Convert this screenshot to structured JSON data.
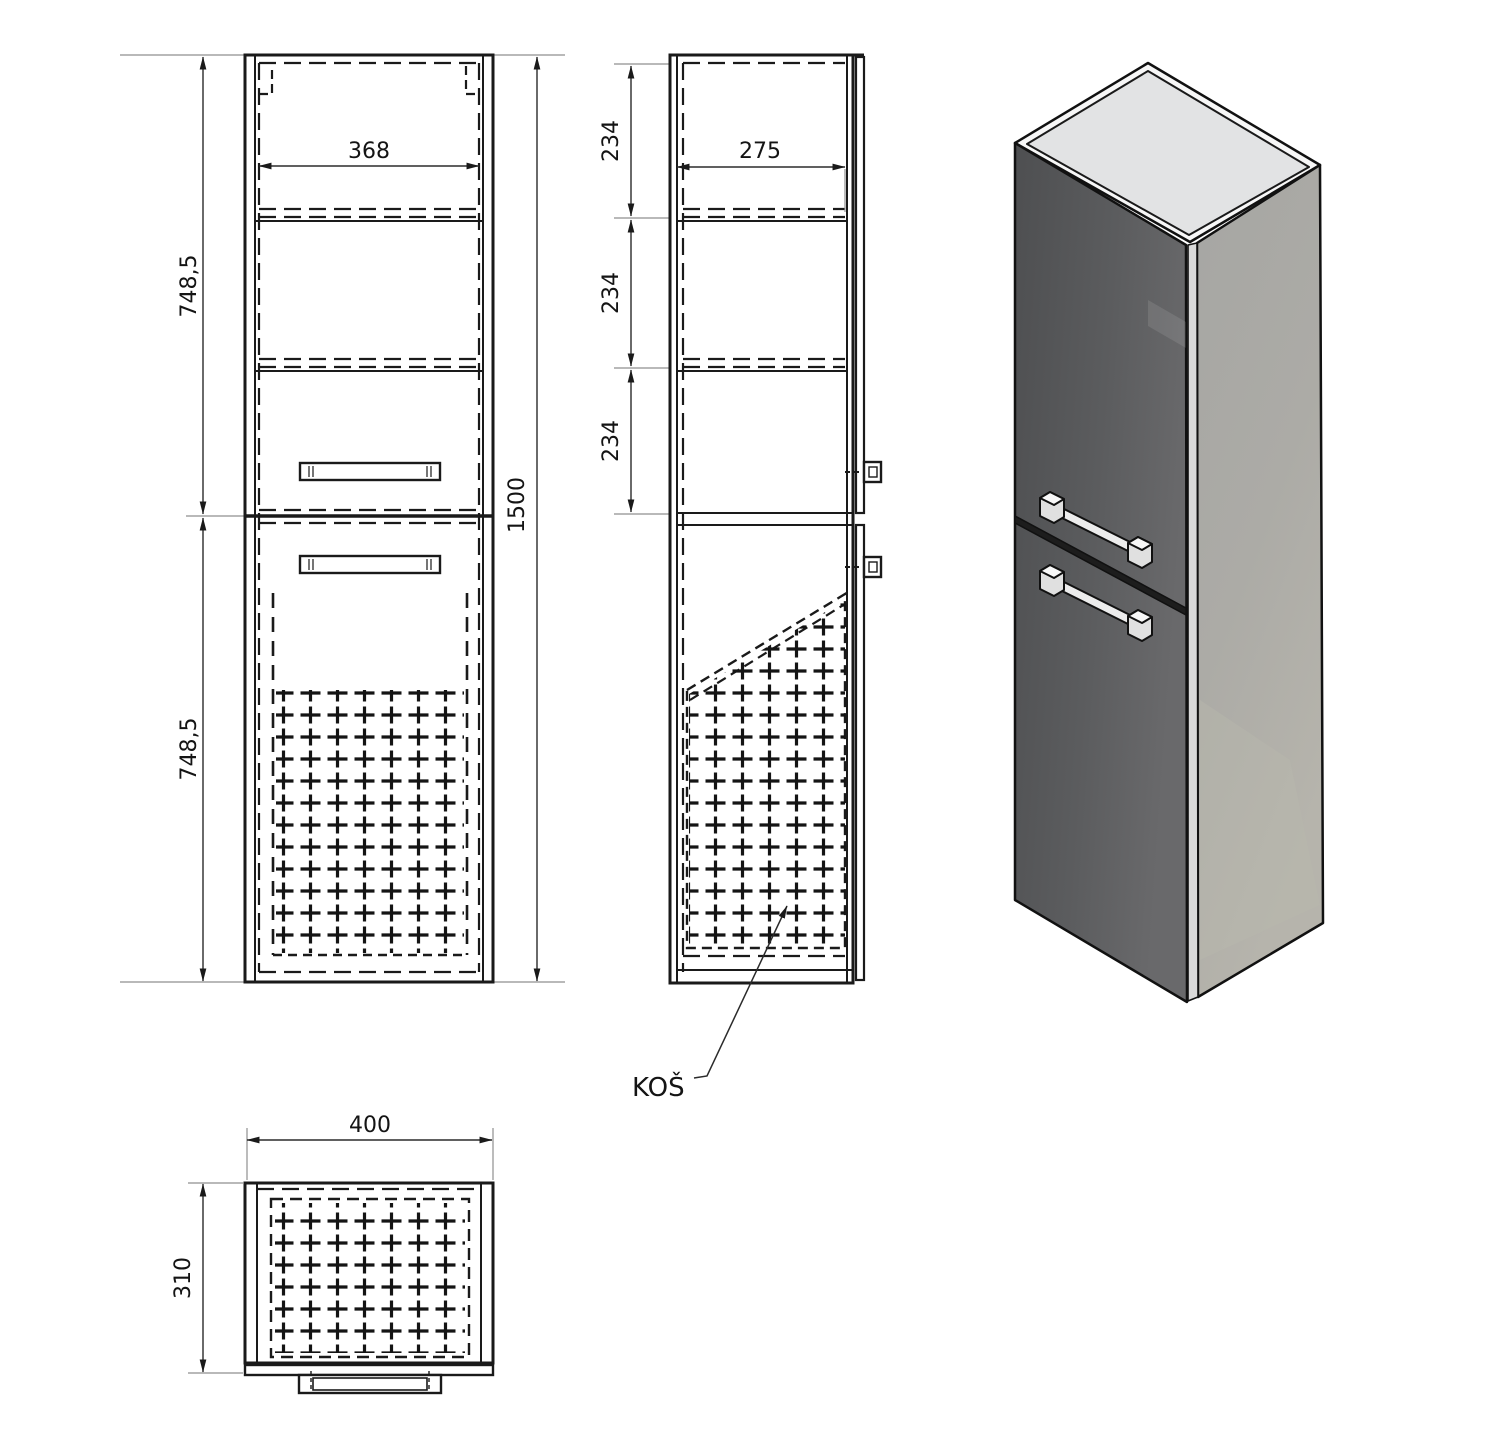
{
  "drawing": {
    "front_view": {
      "inner_width": "368",
      "upper_height": "748,5",
      "lower_height": "748,5",
      "total_height": "1500"
    },
    "side_view": {
      "section_top": "234",
      "section_middle": "234",
      "section_bottom": "234",
      "inner_depth": "275",
      "basket_label": "KOŠ"
    },
    "top_view": {
      "outer_width": "400",
      "outer_depth": "310"
    },
    "colors": {
      "line": "#1a1a1a",
      "dim_line": "#2b2b2b",
      "ext_line": "#8f8f8f",
      "iso_door_face": "#57585a",
      "iso_side_face": "#a9a9a5",
      "iso_top_face": "#e2e3e4"
    }
  }
}
